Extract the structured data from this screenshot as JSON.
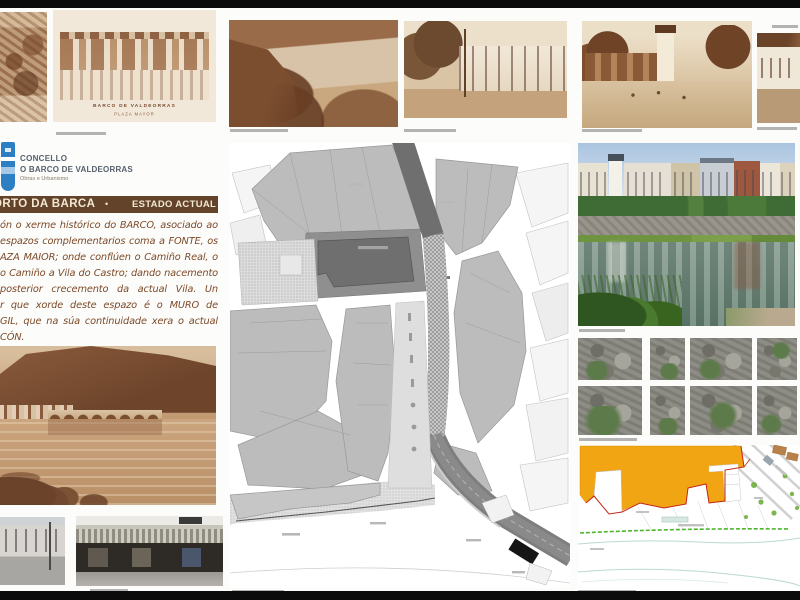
{
  "poster": {
    "logo": {
      "shield_icon": "town-crest-shield",
      "line1": "CONCELLO",
      "line2": "O BARCO DE VALDEORRAS",
      "line3": "Obras e Urbanismo"
    },
    "title_bar": {
      "title": "ORTO DA BARCA",
      "bullet": "•",
      "status": "ESTADO ACTUAL"
    },
    "intro_lines": [
      "ón o xerme histórico do BARCO, asociado ao",
      "espazos complementarios coma a FONTE, os",
      "AZA MAIOR; onde conflúen o Camiño Real, o",
      "o Camiño a Vila do Castro; dando nacemento",
      "posterior crecemento da actual Vila. Un",
      "r que xorde deste espazo é o MURO de",
      "GIL, que na súa continuidade xera o actual",
      "CÓN."
    ],
    "historic_postcard": {
      "caption_line1": "BARCO DE VALDEORRAS",
      "caption_line2": "PLAZA MAYOR"
    },
    "colors": {
      "title_bar_bg": "#63442a",
      "intro_text": "#7d4a28",
      "logo_blue": "#2d7fc3",
      "zoning_yellow": "#f2a513",
      "boundary_red": "#c22618",
      "riverwalk_green": "#4db32b",
      "map_block_gray": "#bcbcbc"
    }
  }
}
